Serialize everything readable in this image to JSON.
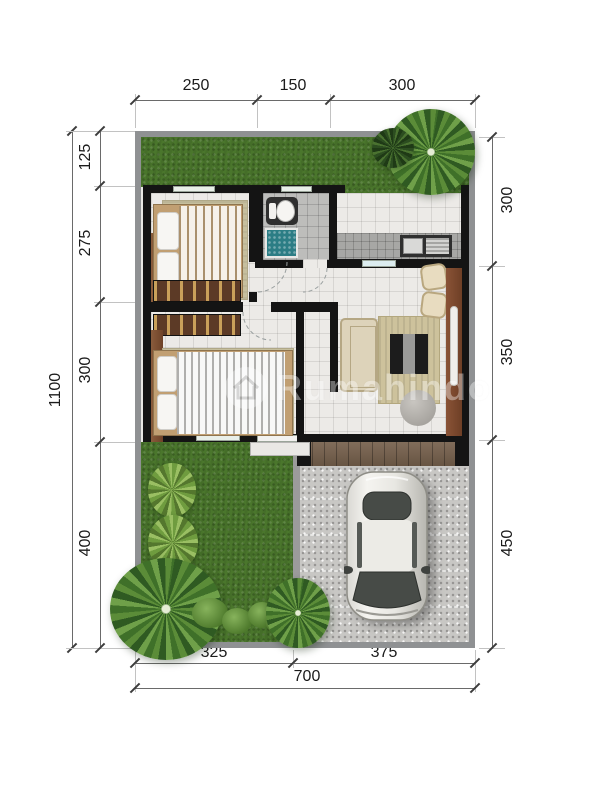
{
  "watermark": {
    "name": "Rumahindo"
  },
  "dimensions": {
    "top": [
      "250",
      "150",
      "300"
    ],
    "left_total": "1100",
    "left": [
      "125",
      "275",
      "300",
      "400"
    ],
    "right": [
      "300",
      "350",
      "450"
    ],
    "bottom": [
      "325",
      "375"
    ],
    "bottom_total": "700"
  },
  "colors": {
    "grass": "#4a762c",
    "wall": "#141414",
    "wood": "#7a4a31",
    "floor_tile": "#eceae7",
    "water_tub": "#2c7d85",
    "fence": "#8f9193",
    "gravel": "#c8c7c4",
    "dimension_text": "#1b1b1b"
  }
}
